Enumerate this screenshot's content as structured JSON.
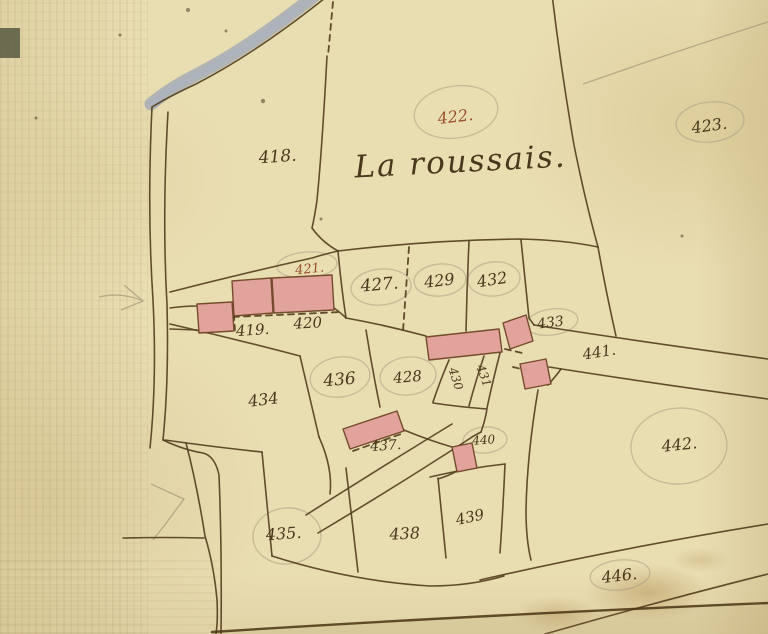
{
  "map": {
    "region_name": "La roussais.",
    "colors": {
      "paper": "#e9ddb2",
      "ink": "#4a381c",
      "red": "#9a4f2c",
      "building_fill": "#e2a09b",
      "building_stroke": "#6f4526",
      "water_wash": "#99a2b7",
      "pencil": "#988c6f"
    },
    "title_label": {
      "text": "La roussais.",
      "x": 461,
      "y": 172,
      "size": 31,
      "rot": -3,
      "ink": "ink"
    },
    "parcel_labels": [
      {
        "text": "418.",
        "x": 278,
        "y": 162,
        "size": 17,
        "rot": -4,
        "ink": "ink"
      },
      {
        "text": "422.",
        "x": 456,
        "y": 122,
        "size": 16,
        "rot": -7,
        "ink": "red"
      },
      {
        "text": "423.",
        "x": 710,
        "y": 131,
        "size": 16,
        "rot": -8,
        "ink": "ink"
      },
      {
        "text": "421.",
        "x": 310,
        "y": 273,
        "size": 13,
        "rot": -6,
        "ink": "red"
      },
      {
        "text": "427.",
        "x": 380,
        "y": 290,
        "size": 17,
        "rot": -5,
        "ink": "ink"
      },
      {
        "text": "429",
        "x": 440,
        "y": 286,
        "size": 16,
        "rot": -7,
        "ink": "ink"
      },
      {
        "text": "432",
        "x": 493,
        "y": 285,
        "size": 16,
        "rot": -9,
        "ink": "ink"
      },
      {
        "text": "419.",
        "x": 253,
        "y": 335,
        "size": 15,
        "rot": -4,
        "ink": "ink"
      },
      {
        "text": "420",
        "x": 308,
        "y": 328,
        "size": 15,
        "rot": -3,
        "ink": "ink"
      },
      {
        "text": "433",
        "x": 551,
        "y": 327,
        "size": 14,
        "rot": -7,
        "ink": "ink"
      },
      {
        "text": "441.",
        "x": 600,
        "y": 357,
        "size": 15,
        "rot": -9,
        "ink": "ink"
      },
      {
        "text": "436",
        "x": 340,
        "y": 385,
        "size": 17,
        "rot": -5,
        "ink": "ink"
      },
      {
        "text": "428",
        "x": 408,
        "y": 382,
        "size": 15,
        "rot": -5,
        "ink": "ink"
      },
      {
        "text": "430",
        "x": 452,
        "y": 380,
        "size": 12,
        "rot": 72,
        "ink": "ink"
      },
      {
        "text": "431",
        "x": 480,
        "y": 377,
        "size": 12,
        "rot": 70,
        "ink": "ink"
      },
      {
        "text": "434",
        "x": 264,
        "y": 405,
        "size": 16,
        "rot": -7,
        "ink": "ink"
      },
      {
        "text": "437.",
        "x": 386,
        "y": 450,
        "size": 14,
        "rot": -4,
        "ink": "ink"
      },
      {
        "text": "440",
        "x": 484,
        "y": 444,
        "size": 12,
        "rot": -4,
        "ink": "ink"
      },
      {
        "text": "442.",
        "x": 680,
        "y": 450,
        "size": 16,
        "rot": -6,
        "ink": "ink"
      },
      {
        "text": "435.",
        "x": 284,
        "y": 539,
        "size": 16,
        "rot": -4,
        "ink": "ink"
      },
      {
        "text": "438",
        "x": 405,
        "y": 539,
        "size": 16,
        "rot": -3,
        "ink": "ink"
      },
      {
        "text": "439",
        "x": 471,
        "y": 522,
        "size": 15,
        "rot": -12,
        "ink": "ink"
      },
      {
        "text": "446.",
        "x": 620,
        "y": 581,
        "size": 16,
        "rot": -7,
        "ink": "ink"
      }
    ]
  }
}
